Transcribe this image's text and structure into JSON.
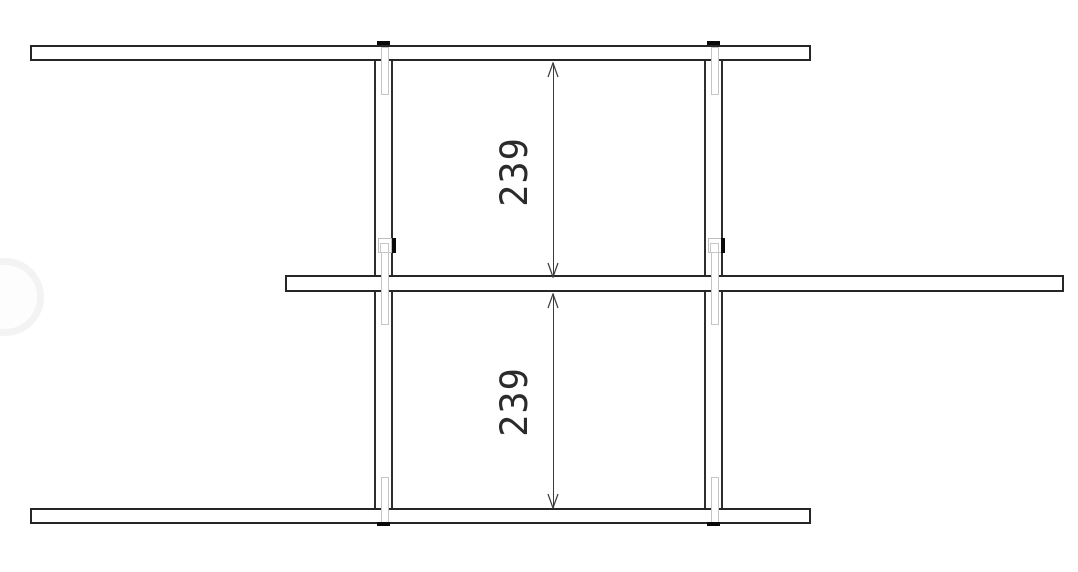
{
  "drawing": {
    "dimension_labels": {
      "upper": "239",
      "lower": "239"
    },
    "colors": {
      "background": "#ffffff",
      "board_outline": "#262626",
      "post_outline": "#2e2e2e",
      "dimension_line": "#3a3a3a",
      "dimension_text": "#2b2b2b",
      "fitting_gray": "#c6c6c6",
      "fastener_black": "#0a0a0a",
      "watermark": "#f3f3f3"
    }
  }
}
